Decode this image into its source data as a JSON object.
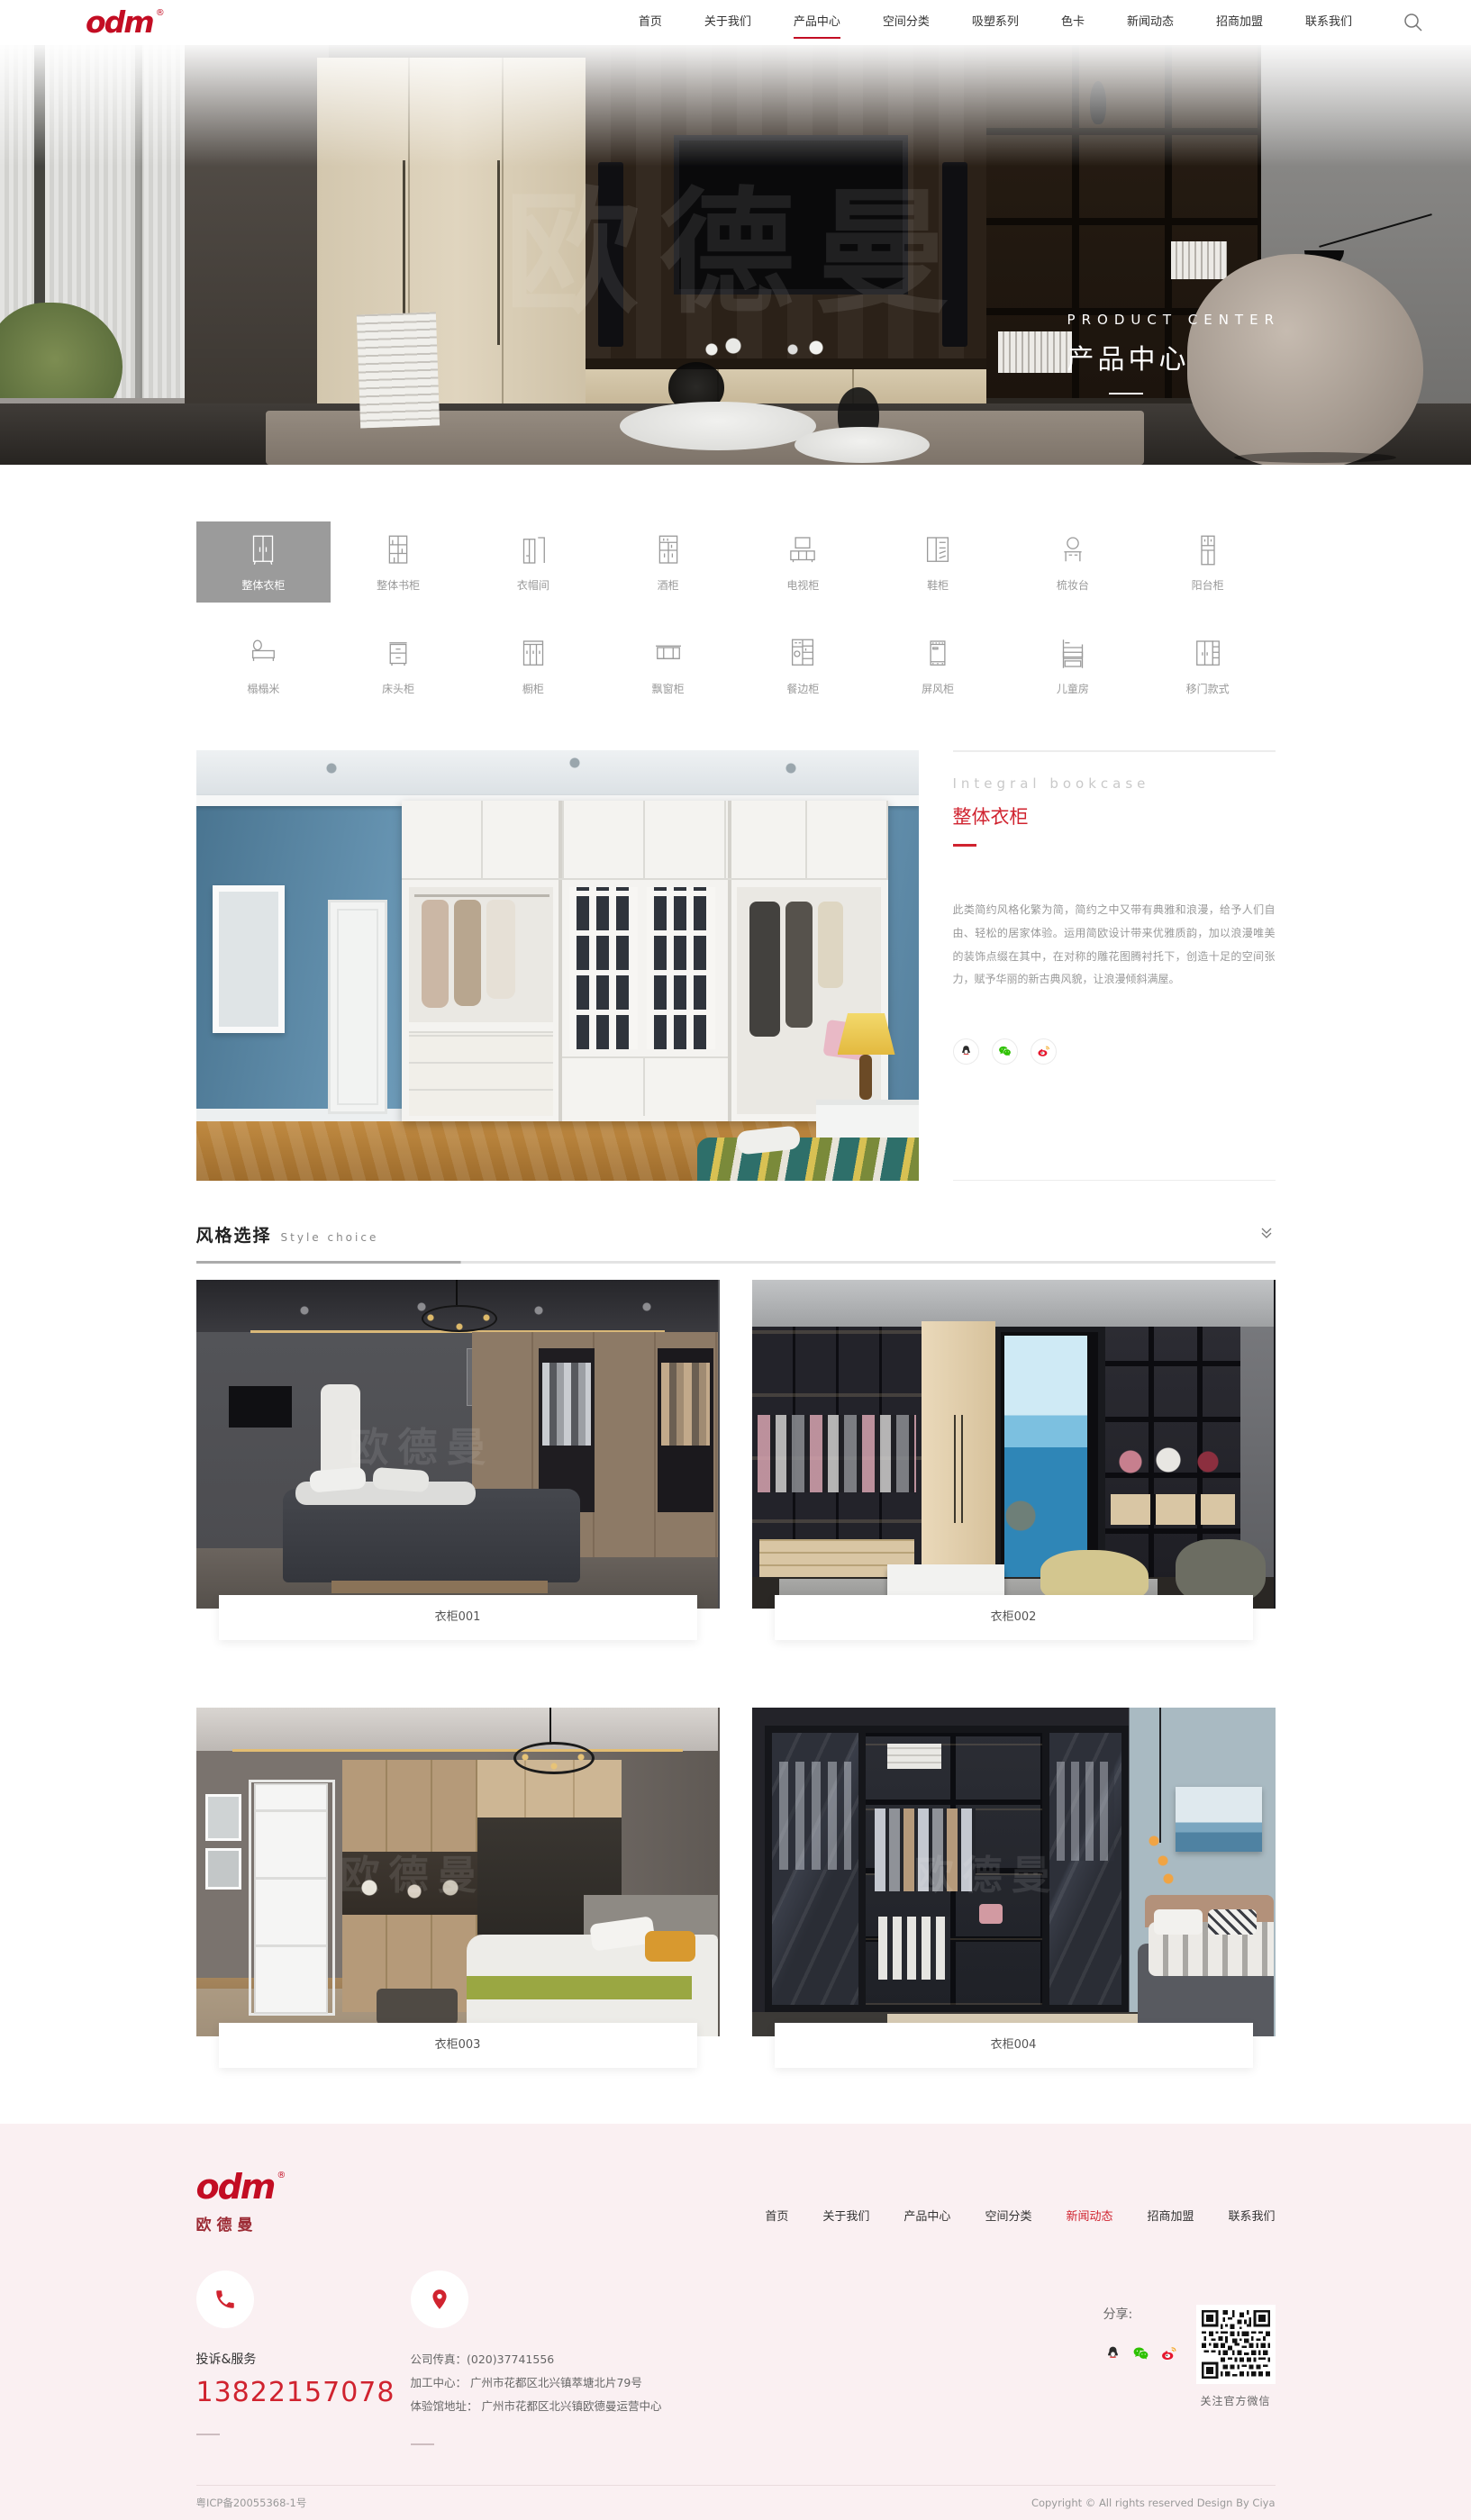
{
  "brand": {
    "logo_text": "odm",
    "registered": "®",
    "logo_sub": "欧德曼",
    "watermark": "欧德曼",
    "logo_red": "#c30d23",
    "accent_red": "#d0232f",
    "footer_bg": "#faf0f2",
    "selected_gray": "#9b9b9b"
  },
  "header": {
    "nav": [
      {
        "label": "首页",
        "active": false
      },
      {
        "label": "关于我们",
        "active": false
      },
      {
        "label": "产品中心",
        "active": true
      },
      {
        "label": "空间分类",
        "active": false
      },
      {
        "label": "吸塑系列",
        "active": false
      },
      {
        "label": "色卡",
        "active": false
      },
      {
        "label": "新闻动态",
        "active": false
      },
      {
        "label": "招商加盟",
        "active": false
      },
      {
        "label": "联系我们",
        "active": false
      }
    ]
  },
  "hero": {
    "title_en": "PRODUCT CENTER",
    "title_zh": "产品中心"
  },
  "categories": {
    "active_index": 0,
    "items": [
      {
        "label": "整体衣柜",
        "icon": "wardrobe-icon",
        "active": true
      },
      {
        "label": "整体书柜",
        "icon": "bookcase-icon",
        "active": false
      },
      {
        "label": "衣帽间",
        "icon": "cloakroom-icon",
        "active": false
      },
      {
        "label": "酒柜",
        "icon": "wine-cabinet-icon",
        "active": false
      },
      {
        "label": "电视柜",
        "icon": "tv-cabinet-icon",
        "active": false
      },
      {
        "label": "鞋柜",
        "icon": "shoe-cabinet-icon",
        "active": false
      },
      {
        "label": "梳妆台",
        "icon": "dressing-table-icon",
        "active": false
      },
      {
        "label": "阳台柜",
        "icon": "balcony-cabinet-icon",
        "active": false
      },
      {
        "label": "榻榻米",
        "icon": "tatami-icon",
        "active": false
      },
      {
        "label": "床头柜",
        "icon": "nightstand-icon",
        "active": false
      },
      {
        "label": "橱柜",
        "icon": "cupboard-icon",
        "active": false
      },
      {
        "label": "飘窗柜",
        "icon": "bay-window-cabinet-icon",
        "active": false
      },
      {
        "label": "餐边柜",
        "icon": "sideboard-icon",
        "active": false
      },
      {
        "label": "屏风柜",
        "icon": "screen-cabinet-icon",
        "active": false
      },
      {
        "label": "儿童房",
        "icon": "kids-room-icon",
        "active": false
      },
      {
        "label": "移门款式",
        "icon": "sliding-door-icon",
        "active": false
      }
    ]
  },
  "detail": {
    "subtitle_en": "Integral bookcase",
    "title_zh": "整体衣柜",
    "description": "此类简约风格化繁为简，简约之中又带有典雅和浪漫，给予人们自由、轻松的居家体验。运用简欧设计带来优雅质韵，加以浪漫唯美的装饰点缀在其中，在对称的雕花图腾衬托下，创造十足的空间张力，赋予华丽的新古典风貌，让浪漫倾斜满屋。",
    "share_icons": [
      "qq-icon",
      "wechat-icon",
      "weibo-icon"
    ]
  },
  "style_section": {
    "title_zh": "风格选择",
    "title_en": "Style choice"
  },
  "products": [
    {
      "name": "衣柜001"
    },
    {
      "name": "衣柜002"
    },
    {
      "name": "衣柜003"
    },
    {
      "name": "衣柜004"
    }
  ],
  "footer": {
    "nav": [
      {
        "label": "首页",
        "active": false
      },
      {
        "label": "关于我们",
        "active": false
      },
      {
        "label": "产品中心",
        "active": false
      },
      {
        "label": "空间分类",
        "active": false
      },
      {
        "label": "新闻动态",
        "active": true
      },
      {
        "label": "招商加盟",
        "active": false
      },
      {
        "label": "联系我们",
        "active": false
      }
    ],
    "service_label": "投诉&服务",
    "service_phone": "13822157078",
    "address_lines": [
      "公司传真：(020)37741556",
      "加工中心： 广州市花都区北兴镇萃塘北片79号",
      "体验馆地址： 广州市花都区北兴镇欧德曼运营中心"
    ],
    "share_label": "分享:",
    "qr_caption": "关注官方微信",
    "icp": "粤ICP备20055368-1号",
    "copyright": "Copyright © All rights reserved Design By Ciya"
  }
}
